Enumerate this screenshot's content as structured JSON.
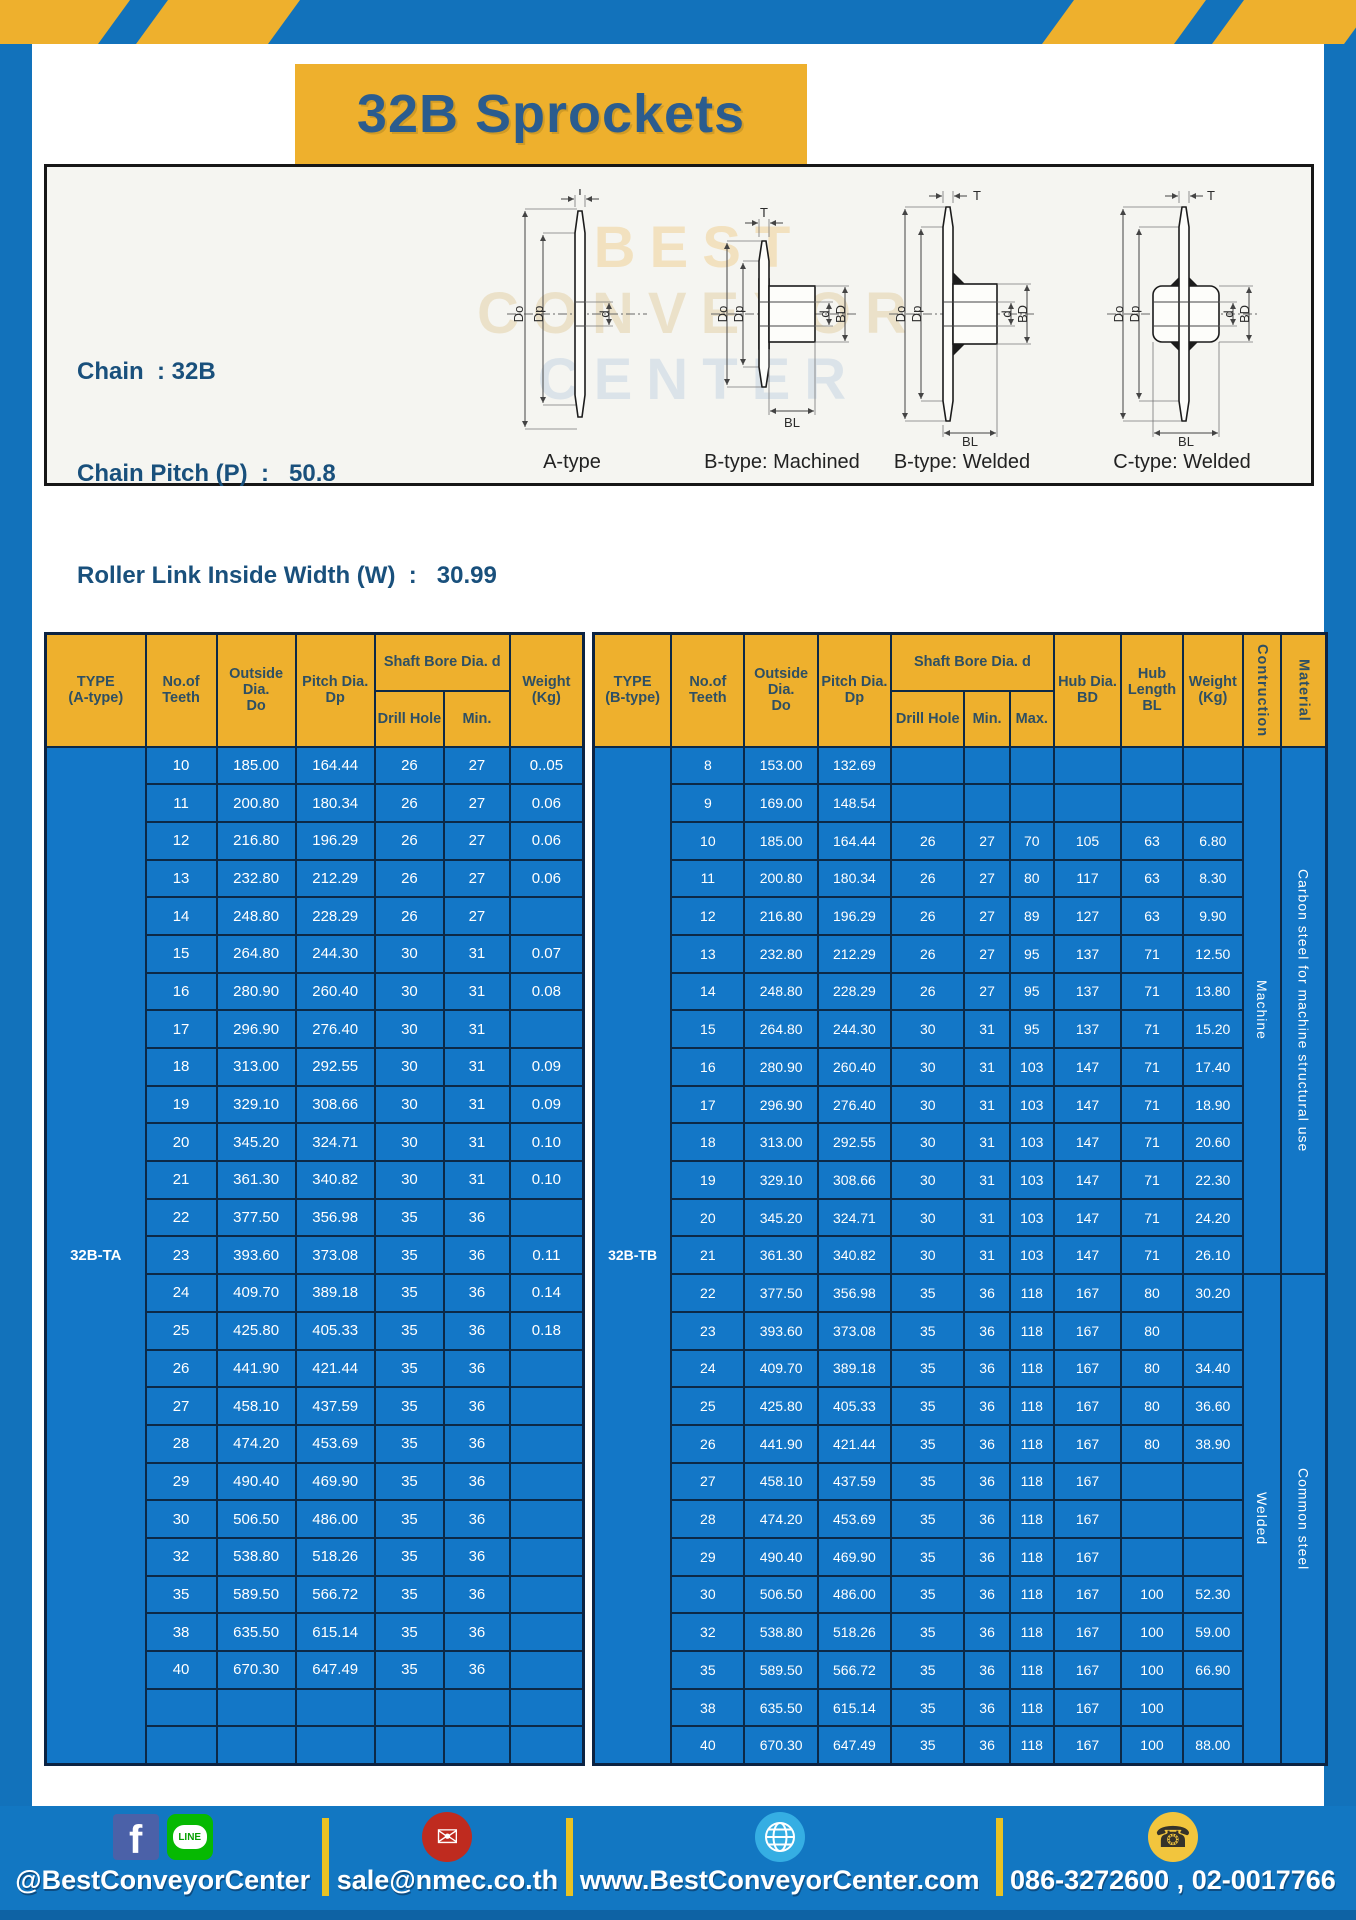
{
  "title": "32B Sprockets",
  "colors": {
    "frame_blue": "#1272bb",
    "accent_yellow": "#eeb02d",
    "table_blue": "#1377c7",
    "border_navy": "#0c2947",
    "title_blue": "#2b5c8e",
    "spec_text_blue": "#19507c"
  },
  "panel": {
    "specs": [
      "Chain  : 32B",
      "Chain Pitch (P)  :   50.8",
      "Roller Link Inside Width (W)  :   30.99",
      "Roller Diameter (Dr)  : 29.21",
      "Teeth Width (T)  :   29.4"
    ],
    "watermark": [
      "BEST",
      "CONVEYOR",
      "CENTER"
    ],
    "captions": [
      "A-type",
      "B-type: Machined",
      "B-type: Welded",
      "C-type: Welded"
    ],
    "dims": {
      "t": "T",
      "dout": "Do",
      "dp": "Dp",
      "d": "d",
      "bd": "BD",
      "bl": "BL"
    }
  },
  "left_table": {
    "headers": {
      "type": "TYPE\n(A-type)",
      "teeth": "No.of\nTeeth",
      "outside": "Outside\nDia.\nDo",
      "pitch": "Pitch Dia.\nDp",
      "shaft_group": "Shaft Bore Dia. d",
      "drill": "Drill Hole",
      "min": "Min.",
      "weight": "Weight\n(Kg)"
    },
    "rows": [
      [
        {
          "t": "32B-TA",
          "rs": 27,
          "cls": "type-cell",
          "n": "type-label-cell"
        },
        "10",
        "185.00",
        "164.44",
        "26",
        "27",
        "0..05"
      ],
      [
        "11",
        "200.80",
        "180.34",
        "26",
        "27",
        "0.06"
      ],
      [
        "12",
        "216.80",
        "196.29",
        "26",
        "27",
        "0.06"
      ],
      [
        "13",
        "232.80",
        "212.29",
        "26",
        "27",
        "0.06"
      ],
      [
        "14",
        "248.80",
        "228.29",
        "26",
        "27",
        ""
      ],
      [
        "15",
        "264.80",
        "244.30",
        "30",
        "31",
        "0.07"
      ],
      [
        "16",
        "280.90",
        "260.40",
        "30",
        "31",
        "0.08"
      ],
      [
        "17",
        "296.90",
        "276.40",
        "30",
        "31",
        ""
      ],
      [
        "18",
        "313.00",
        "292.55",
        "30",
        "31",
        "0.09"
      ],
      [
        "19",
        "329.10",
        "308.66",
        "30",
        "31",
        "0.09"
      ],
      [
        "20",
        "345.20",
        "324.71",
        "30",
        "31",
        "0.10"
      ],
      [
        "21",
        "361.30",
        "340.82",
        "30",
        "31",
        "0.10"
      ],
      [
        "22",
        "377.50",
        "356.98",
        "35",
        "36",
        ""
      ],
      [
        "23",
        "393.60",
        "373.08",
        "35",
        "36",
        "0.11"
      ],
      [
        "24",
        "409.70",
        "389.18",
        "35",
        "36",
        "0.14"
      ],
      [
        "25",
        "425.80",
        "405.33",
        "35",
        "36",
        "0.18"
      ],
      [
        "26",
        "441.90",
        "421.44",
        "35",
        "36",
        ""
      ],
      [
        "27",
        "458.10",
        "437.59",
        "35",
        "36",
        ""
      ],
      [
        "28",
        "474.20",
        "453.69",
        "35",
        "36",
        ""
      ],
      [
        "29",
        "490.40",
        "469.90",
        "35",
        "36",
        ""
      ],
      [
        "30",
        "506.50",
        "486.00",
        "35",
        "36",
        ""
      ],
      [
        "32",
        "538.80",
        "518.26",
        "35",
        "36",
        ""
      ],
      [
        "35",
        "589.50",
        "566.72",
        "35",
        "36",
        ""
      ],
      [
        "38",
        "635.50",
        "615.14",
        "35",
        "36",
        ""
      ],
      [
        "40",
        "670.30",
        "647.49",
        "35",
        "36",
        ""
      ],
      [
        "",
        "",
        "",
        "",
        "",
        ""
      ],
      [
        "",
        "",
        "",
        "",
        "",
        ""
      ]
    ]
  },
  "right_table": {
    "headers": {
      "type": "TYPE\n(B-type)",
      "teeth": "No.of\nTeeth",
      "outside": "Outside\nDia.\nDo",
      "pitch": "Pitch Dia.\nDp",
      "shaft_group": "Shaft Bore Dia. d",
      "drill": "Drill Hole",
      "min": "Min.",
      "max": "Max.",
      "hub_dia": "Hub Dia.\nBD",
      "hub_len": "Hub\nLength\nBL",
      "weight": "Weight\n(Kg)",
      "construction": "Contruction",
      "material": "Material"
    },
    "construction_groups": [
      "Machine",
      "Welded"
    ],
    "material_groups": [
      "Carbon steel for machine structural use",
      "Common steel"
    ],
    "rows": [
      [
        {
          "t": "32B-TB",
          "rs": 27,
          "cls": "type-cell",
          "n": "type-label-cell"
        },
        "8",
        "153.00",
        "132.69",
        "",
        "",
        "",
        "",
        "",
        "",
        {
          "t": "Machine",
          "rs": 14,
          "cls": "vert",
          "n": "construction-cell"
        },
        {
          "t": "Carbon steel for machine structural use",
          "rs": 14,
          "cls": "vert vsm",
          "n": "material-cell"
        }
      ],
      [
        "9",
        "169.00",
        "148.54",
        "",
        "",
        "",
        "",
        "",
        ""
      ],
      [
        "10",
        "185.00",
        "164.44",
        "26",
        "27",
        "70",
        "105",
        "63",
        "6.80"
      ],
      [
        "11",
        "200.80",
        "180.34",
        "26",
        "27",
        "80",
        "117",
        "63",
        "8.30"
      ],
      [
        "12",
        "216.80",
        "196.29",
        "26",
        "27",
        "89",
        "127",
        "63",
        "9.90"
      ],
      [
        "13",
        "232.80",
        "212.29",
        "26",
        "27",
        "95",
        "137",
        "71",
        "12.50"
      ],
      [
        "14",
        "248.80",
        "228.29",
        "26",
        "27",
        "95",
        "137",
        "71",
        "13.80"
      ],
      [
        "15",
        "264.80",
        "244.30",
        "30",
        "31",
        "95",
        "137",
        "71",
        "15.20"
      ],
      [
        "16",
        "280.90",
        "260.40",
        "30",
        "31",
        "103",
        "147",
        "71",
        "17.40"
      ],
      [
        "17",
        "296.90",
        "276.40",
        "30",
        "31",
        "103",
        "147",
        "71",
        "18.90"
      ],
      [
        "18",
        "313.00",
        "292.55",
        "30",
        "31",
        "103",
        "147",
        "71",
        "20.60"
      ],
      [
        "19",
        "329.10",
        "308.66",
        "30",
        "31",
        "103",
        "147",
        "71",
        "22.30"
      ],
      [
        "20",
        "345.20",
        "324.71",
        "30",
        "31",
        "103",
        "147",
        "71",
        "24.20"
      ],
      [
        "21",
        "361.30",
        "340.82",
        "30",
        "31",
        "103",
        "147",
        "71",
        "26.10"
      ],
      [
        "22",
        "377.50",
        "356.98",
        "35",
        "36",
        "118",
        "167",
        "80",
        "30.20",
        {
          "t": "Welded",
          "rs": 13,
          "cls": "vert",
          "n": "construction-cell"
        },
        {
          "t": "Common steel",
          "rs": 13,
          "cls": "vert vsm",
          "n": "material-cell"
        }
      ],
      [
        "23",
        "393.60",
        "373.08",
        "35",
        "36",
        "118",
        "167",
        "80",
        ""
      ],
      [
        "24",
        "409.70",
        "389.18",
        "35",
        "36",
        "118",
        "167",
        "80",
        "34.40"
      ],
      [
        "25",
        "425.80",
        "405.33",
        "35",
        "36",
        "118",
        "167",
        "80",
        "36.60"
      ],
      [
        "26",
        "441.90",
        "421.44",
        "35",
        "36",
        "118",
        "167",
        "80",
        "38.90"
      ],
      [
        "27",
        "458.10",
        "437.59",
        "35",
        "36",
        "118",
        "167",
        "",
        ""
      ],
      [
        "28",
        "474.20",
        "453.69",
        "35",
        "36",
        "118",
        "167",
        "",
        ""
      ],
      [
        "29",
        "490.40",
        "469.90",
        "35",
        "36",
        "118",
        "167",
        "",
        ""
      ],
      [
        "30",
        "506.50",
        "486.00",
        "35",
        "36",
        "118",
        "167",
        "100",
        "52.30"
      ],
      [
        "32",
        "538.80",
        "518.26",
        "35",
        "36",
        "118",
        "167",
        "100",
        "59.00"
      ],
      [
        "35",
        "589.50",
        "566.72",
        "35",
        "36",
        "118",
        "167",
        "100",
        "66.90"
      ],
      [
        "38",
        "635.50",
        "615.14",
        "35",
        "36",
        "118",
        "167",
        "100",
        ""
      ],
      [
        "40",
        "670.30",
        "647.49",
        "35",
        "36",
        "118",
        "167",
        "100",
        "88.00"
      ]
    ]
  },
  "footer": {
    "social_label": "@BestConveyorCenter",
    "email": "sale@nmec.co.th",
    "website": "www.BestConveyorCenter.com",
    "phone": "086-3272600 , 02-0017766",
    "icons": {
      "facebook": "f",
      "line": "LINE",
      "email": "✉",
      "phone": "☎"
    }
  }
}
